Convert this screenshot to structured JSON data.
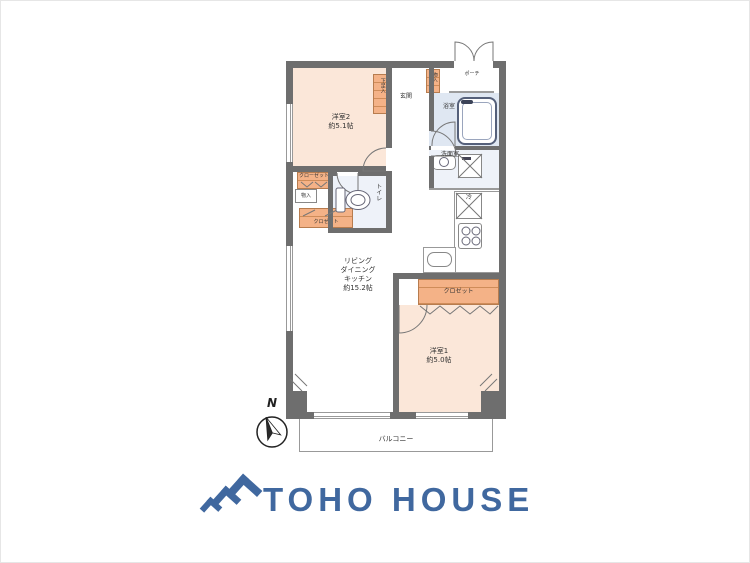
{
  "floorplan": {
    "compass_label": "N",
    "balcony_label": "バルコニー",
    "rooms": {
      "bedroom2": {
        "name": "洋室2",
        "area": "約5.1帖"
      },
      "bedroom1": {
        "name": "洋室1",
        "area": "約5.0帖"
      },
      "ldk": {
        "name_lines": [
          "リビング",
          "ダイニング",
          "キッチン"
        ],
        "area": "約15.2帖"
      },
      "bathroom": {
        "name": "浴室"
      },
      "washroom": {
        "name": "洗面室"
      },
      "toilet": {
        "name": "トイレ"
      },
      "entrance": {
        "name": "玄関"
      },
      "porch": {
        "name": "ポーチ"
      }
    },
    "storage": {
      "shoe_cabinet": "下足入",
      "hall_storage": "物入",
      "bedroom2_closet_upper": "クローゼット",
      "bedroom2_storage": "物入",
      "bedroom2_closet_lower": "クロゼット",
      "bedroom1_closet": "クロゼット",
      "refrigerator_label": "冷"
    },
    "colors": {
      "wall": "#6e6e6e",
      "room_peach": "#fbe7d9",
      "wet_area_blue": "#dfe7f2",
      "closet_orange": "#f1ad7d"
    }
  },
  "brand": {
    "logo_text": "TOHO HOUSE",
    "logo_color": "#40689f"
  }
}
